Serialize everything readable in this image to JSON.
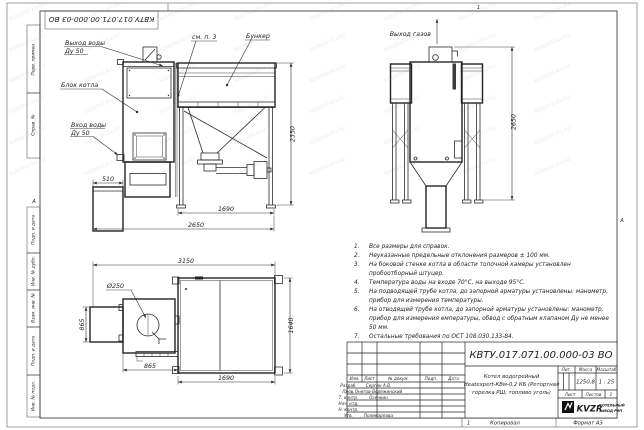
{
  "doc_number": "КВТУ.017.071.00.000-03 ВО",
  "watermark": "kotelnii-kv.kz",
  "frame": {
    "stamp_vertical_labels": [
      "Перв. примен.",
      "Справ. №",
      "Подп. и дата",
      "Инв. № дубл.",
      "Взам. инв. №",
      "Подп. и дата",
      "Инв. № подл."
    ],
    "zone_marker_left": "А",
    "zone_marker_right": "А",
    "fold_mark_top": "1"
  },
  "drawing": {
    "front_view": {
      "label_water_out_1": "Выход воды",
      "label_water_out_2": "Ду 50",
      "label_boiler": "Блок котла",
      "label_water_in_1": "Вход воды",
      "label_water_in_2": "Ду 50",
      "label_see_note": "см. п. 3",
      "label_bunker": "Бункер",
      "dim_height": "2350",
      "dim_ashbox": "510",
      "dim_bunker_width": "1690",
      "dim_total_width": "2650"
    },
    "rear_view": {
      "label_gas_out": "Выход газов",
      "dim_height": "2650"
    },
    "plan_view": {
      "dim_total_width": "3150",
      "label_chimney_dia": "Ø250",
      "dim_left_depth": "865",
      "dim_boiler_width": "865",
      "dim_bunker_width": "1690",
      "dim_bunker_depth": "1640"
    }
  },
  "notes": [
    {
      "num": "1.",
      "text": "Все размеры для справок."
    },
    {
      "num": "2.",
      "text": "Неуказанные предельные отклонения размеров ± 100 мм."
    },
    {
      "num": "3.",
      "text": "На боковой стенке котла в области топочной камеры установлен пробоотборный штуцер."
    },
    {
      "num": "4.",
      "text": "Температура воды на входе 70°С, на выходе 95°С."
    },
    {
      "num": "5.",
      "text": "На подводящей трубе котла, до запорной арматуры установлены: манометр, прибор для измерения температуры."
    },
    {
      "num": "6.",
      "text": "На отводящей трубе котла, до запорной арматуры установлены: манометр, прибор для измерения емпературы, обвод с обратным клапаном Ду не менее 50 мм."
    },
    {
      "num": "7.",
      "text": "Остальные требования по ОСТ 108.030.133-84."
    }
  ],
  "title_block": {
    "doc_number": "КВТУ.017.071.00.000-03 ВО",
    "product_name_1": "Котел водогрейный",
    "product_name_2": "Heatexpert-КВм-0,2 КБ (Ретортная",
    "product_name_3": "горелка РШ, топливо уголь)",
    "col_izm": "Изм.",
    "col_list": "Лист",
    "col_doc": "№ докум.",
    "col_sign": "Подп.",
    "col_date": "Дата",
    "rows": [
      {
        "role": "Разраб.",
        "name": "Сергин А.В."
      },
      {
        "role": "Пров.",
        "name": "Онегов-Вережинский"
      },
      {
        "role": "Т. контр.",
        "name": "Осечкин"
      },
      {
        "role": "Нач. отд.",
        "name": ""
      },
      {
        "role": "Н. контр.",
        "name": ""
      },
      {
        "role": "Утв.",
        "name": "Поликарпова"
      }
    ],
    "lit_label": "Лит.",
    "mass_label": "Масса",
    "scale_label": "Масштаб",
    "mass_value": "1250,8",
    "scale_value": "1 : 25",
    "sheet_label": "Лист",
    "sheets_label": "Листов",
    "sheets_value": "1",
    "company_abbr": "KVZR",
    "company_line1": "КОТЕЛЬНЫЙ",
    "company_line2": "ЗАВОД РЭП"
  },
  "footer": {
    "copy_num": "1",
    "copied_label": "Копировал",
    "format_label": "Формат А3"
  }
}
